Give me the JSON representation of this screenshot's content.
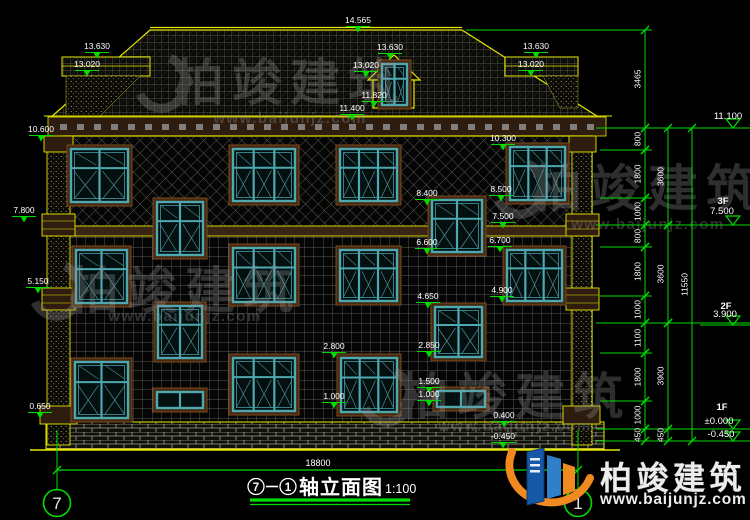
{
  "colors": {
    "background": "#000000",
    "outline_yellow": "#e8e800",
    "dim_green": "#00dc00",
    "text_white": "#ffffff",
    "window_teal": "#4da8b0",
    "surround_brown": "#46290f",
    "watermark_gray": "#9a9a9a",
    "logo_blue": "#1658a8",
    "logo_orange": "#f08a1e"
  },
  "title_block": {
    "axis_from": "7",
    "separator": "-",
    "axis_to": "1",
    "title": "轴立面图",
    "scale": "1:100"
  },
  "bottom_dimension": {
    "value": "18800"
  },
  "axis_bubbles": {
    "left": "7",
    "right": "1"
  },
  "watermark": {
    "brand": "柏竣建筑",
    "url": "www.baijunjz.com"
  },
  "logo": {
    "brand": "柏竣建筑",
    "url": "www.baijunjz.com"
  },
  "watermarks": [
    {
      "cx": 290,
      "brand_y": 100,
      "url_y": 123
    },
    {
      "cx": 648,
      "brand_y": 206,
      "url_y": 229
    },
    {
      "cx": 185,
      "brand_y": 308,
      "url_y": 321
    },
    {
      "cx": 515,
      "brand_y": 414,
      "url_y": 431
    }
  ],
  "elevation_labels": [
    {
      "text": "14.565",
      "x": 358,
      "y": 16
    },
    {
      "text": "13.630",
      "x": 97,
      "y": 42
    },
    {
      "text": "13.020",
      "x": 87,
      "y": 60
    },
    {
      "text": "13.630",
      "x": 390,
      "y": 43
    },
    {
      "text": "13.020",
      "x": 366,
      "y": 61
    },
    {
      "text": "11.820",
      "x": 374,
      "y": 91
    },
    {
      "text": "11.400",
      "x": 352,
      "y": 104
    },
    {
      "text": "13.630",
      "x": 536,
      "y": 42
    },
    {
      "text": "13.020",
      "x": 531,
      "y": 60
    },
    {
      "text": "10.600",
      "x": 41,
      "y": 125
    },
    {
      "text": "7.800",
      "x": 24,
      "y": 206
    },
    {
      "text": "5.150",
      "x": 38,
      "y": 277
    },
    {
      "text": "0.650",
      "x": 40,
      "y": 402
    },
    {
      "text": "10.300",
      "x": 503,
      "y": 134
    },
    {
      "text": "8.400",
      "x": 427,
      "y": 189
    },
    {
      "text": "8.500",
      "x": 501,
      "y": 185
    },
    {
      "text": "7.500",
      "x": 503,
      "y": 212
    },
    {
      "text": "6.600",
      "x": 427,
      "y": 238
    },
    {
      "text": "6.700",
      "x": 500,
      "y": 236
    },
    {
      "text": "4.650",
      "x": 428,
      "y": 292
    },
    {
      "text": "4.900",
      "x": 502,
      "y": 286
    },
    {
      "text": "2.850",
      "x": 429,
      "y": 341
    },
    {
      "text": "2.800",
      "x": 334,
      "y": 342
    },
    {
      "text": "1.500",
      "x": 429,
      "y": 377
    },
    {
      "text": "1.000",
      "x": 429,
      "y": 390
    },
    {
      "text": "1.000",
      "x": 334,
      "y": 392
    },
    {
      "text": "0.400",
      "x": 504,
      "y": 411
    },
    {
      "text": "-0.450",
      "x": 503,
      "y": 432
    }
  ],
  "level_flags": [
    {
      "floor": "",
      "fx": 0,
      "fy": 0,
      "value": "11.100",
      "vx": 728,
      "vy": 119,
      "y": 128
    },
    {
      "floor": "3F",
      "fx": 723,
      "fy": 204,
      "value": "7.500",
      "vx": 722,
      "vy": 214,
      "y": 225
    },
    {
      "floor": "2F",
      "fx": 726,
      "fy": 309,
      "value": "3.900",
      "vx": 725,
      "vy": 317,
      "y": 325
    },
    {
      "floor": "1F",
      "fx": 722,
      "fy": 410,
      "value": "±0.000",
      "vx": 719,
      "vy": 424,
      "y": 429
    },
    {
      "floor": "",
      "fx": 0,
      "fy": 0,
      "value": "-0.450",
      "vx": 721,
      "vy": 437,
      "y": 441
    }
  ],
  "dim_chains": [
    {
      "x": 645,
      "segments": [
        {
          "label": "3465",
          "from": 30,
          "to": 128
        },
        {
          "label": "800",
          "from": 128,
          "to": 150
        },
        {
          "label": "1800",
          "from": 150,
          "to": 198
        },
        {
          "label": "1000",
          "from": 198,
          "to": 225
        },
        {
          "label": "800",
          "from": 225,
          "to": 247
        },
        {
          "label": "1800",
          "from": 247,
          "to": 296
        },
        {
          "label": "1000",
          "from": 296,
          "to": 323
        },
        {
          "label": "1100",
          "from": 323,
          "to": 353
        },
        {
          "label": "1800",
          "from": 353,
          "to": 401
        },
        {
          "label": "1000",
          "from": 401,
          "to": 429
        },
        {
          "label": "450",
          "from": 429,
          "to": 441
        }
      ]
    },
    {
      "x": 668,
      "segments": [
        {
          "label": "3600",
          "from": 128,
          "to": 225
        },
        {
          "label": "3600",
          "from": 225,
          "to": 323
        },
        {
          "label": "3900",
          "from": 323,
          "to": 429
        },
        {
          "label": "450",
          "from": 429,
          "to": 441
        }
      ]
    },
    {
      "x": 692,
      "segments": [
        {
          "label": "11550",
          "from": 128,
          "to": 441
        }
      ]
    }
  ],
  "ext_lines": [
    {
      "y": 30,
      "x1": 466,
      "x2": 652
    },
    {
      "y": 128,
      "x1": 596,
      "x2": 750
    },
    {
      "y": 150,
      "x1": 600,
      "x2": 652
    },
    {
      "y": 198,
      "x1": 600,
      "x2": 652
    },
    {
      "y": 225,
      "x1": 596,
      "x2": 750
    },
    {
      "y": 247,
      "x1": 600,
      "x2": 652
    },
    {
      "y": 296,
      "x1": 600,
      "x2": 652
    },
    {
      "y": 323,
      "x1": 596,
      "x2": 750
    },
    {
      "y": 353,
      "x1": 600,
      "x2": 652
    },
    {
      "y": 401,
      "x1": 600,
      "x2": 652
    },
    {
      "y": 429,
      "x1": 596,
      "x2": 750
    },
    {
      "y": 441,
      "x1": 596,
      "x2": 750
    }
  ]
}
